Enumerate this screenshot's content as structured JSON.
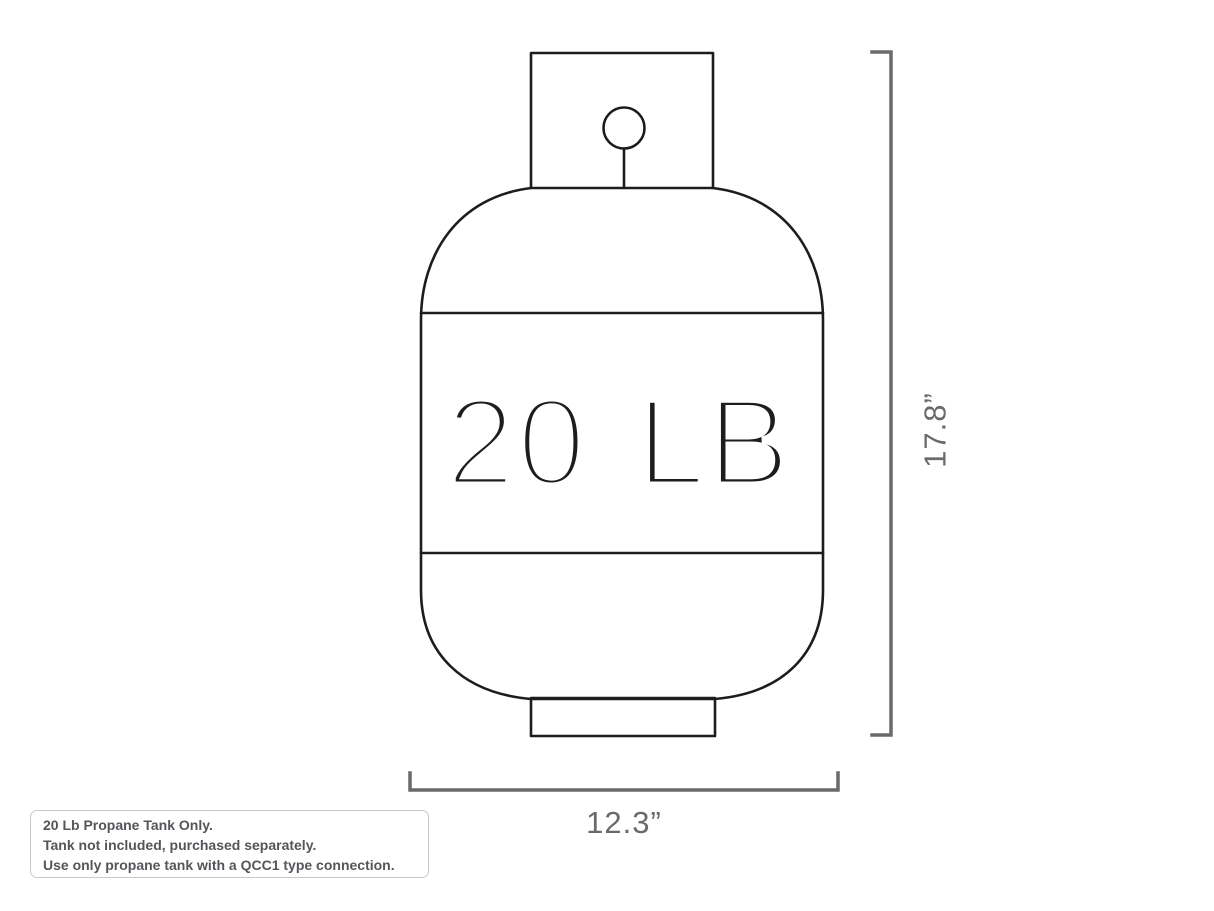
{
  "diagram": {
    "capacity_label": "20 LB",
    "height_dimension_label": "17.8”",
    "width_dimension_label": "12.3”",
    "note_lines": [
      "20 Lb Propane Tank Only.",
      "Tank not included, purchased separately.",
      "Use only propane tank with a QCC1 type connection."
    ],
    "colors": {
      "outline": "#1d1d1d",
      "dimension": "#6a6a6a",
      "note_text": "#55565a",
      "note_border": "#c9c9c9",
      "background": "#ffffff"
    }
  }
}
